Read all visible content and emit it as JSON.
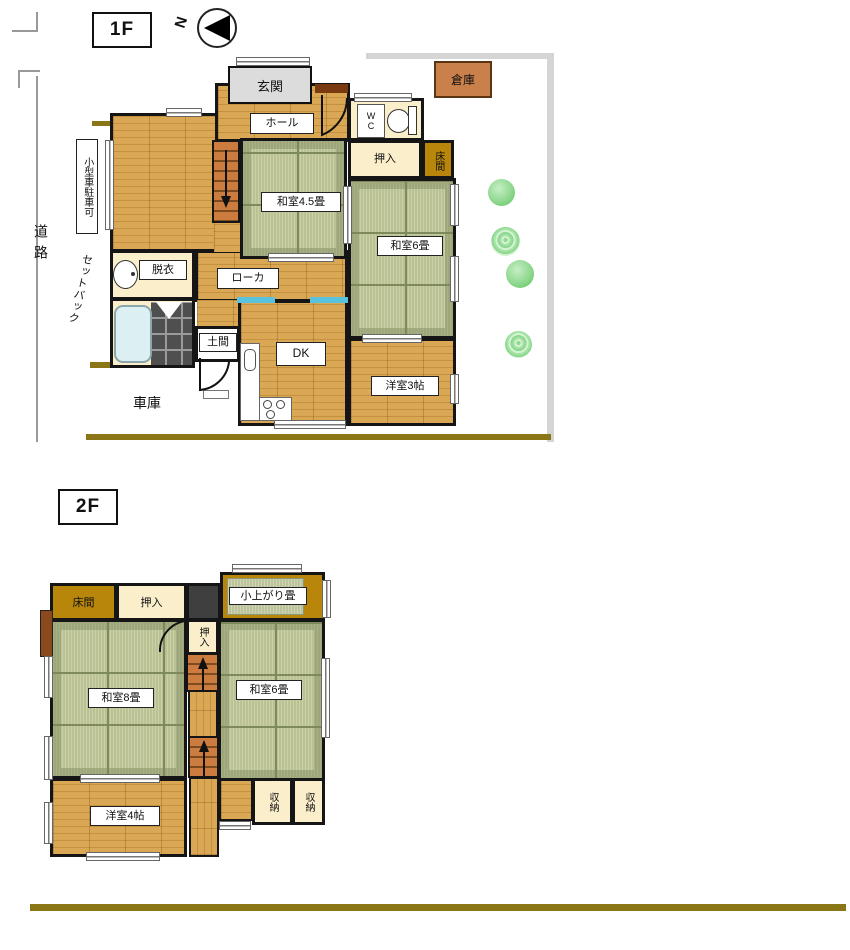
{
  "site": {
    "road": "道路",
    "setback": "セットバック",
    "parking_note": "小型車駐車可",
    "garage": "車庫",
    "warehouse": "倉庫",
    "north": "N"
  },
  "f1": {
    "label": "1F",
    "entrance": "玄関",
    "hall": "ホール",
    "wc": "W\nC",
    "closet": "押入",
    "alcove": "床間",
    "tatami45": "和室4.5畳",
    "tatami6": "和室6畳",
    "corridor": "ローカ",
    "dressing": "脱衣",
    "doma": "土間",
    "dk": "DK",
    "western3": "洋室3帖"
  },
  "f2": {
    "label": "2F",
    "alcove": "床間",
    "closet_top": "押入",
    "raised_tatami": "小上がり畳",
    "closet_mid": "押入",
    "tatami8": "和室8畳",
    "tatami6": "和室6畳",
    "western4": "洋室4帖",
    "storage": "収納"
  },
  "colors": {
    "tatami_green": "#bac292",
    "wood_tan": "#d8a750",
    "alcove_gold": "#b8860b",
    "closet_cream": "#fbeecb",
    "sliding_door_blue": "#59c2dd",
    "shrub_green": "#8fd88f",
    "boundary_gray": "#d5d5d5",
    "site_line_olive": "#8a7617",
    "stair_orange": "#cd7c40"
  }
}
